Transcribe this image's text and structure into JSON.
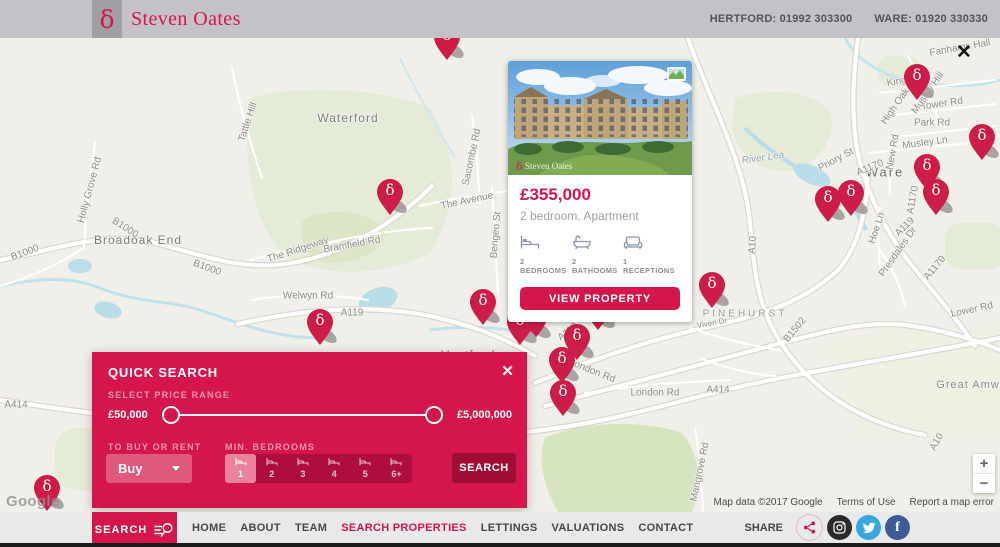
{
  "colors": {
    "accent": "#d5164c",
    "pin": "#cc1c47",
    "search_button": "#9f0d35",
    "panel": "#d4164c",
    "instagram": "#2a2a2a",
    "twitter": "#35a6de",
    "facebook": "#3b5a96"
  },
  "header": {
    "brand": {
      "symbol": "δ",
      "name": "Steven Oates"
    },
    "phones": [
      "HERTFORD: 01992 303300",
      "WARE: 01920 330330"
    ]
  },
  "map": {
    "close_label": "✕",
    "google_logo": "Google",
    "pin_glyph": "δ",
    "controls": {
      "zoom_in": "+",
      "zoom_out": "−"
    },
    "attribution": {
      "map_data": "Map data ©2017 Google",
      "terms": "Terms of Use",
      "report": "Report a map error"
    },
    "labels": [
      {
        "text": "Waterford",
        "x": 348,
        "y": 80,
        "size": 12,
        "color": "#7d7d7b",
        "ls": 1
      },
      {
        "text": "Broadoak End",
        "x": 138,
        "y": 202,
        "size": 12,
        "color": "#7d7d7b",
        "ls": 1
      },
      {
        "text": "Hertford",
        "x": 468,
        "y": 317,
        "size": 13,
        "color": "#757573",
        "ls": 1
      },
      {
        "text": "Ware",
        "x": 885,
        "y": 134,
        "size": 13,
        "color": "#6e6e6c",
        "ls": 2
      },
      {
        "text": "PINEHURST",
        "x": 745,
        "y": 276,
        "size": 10,
        "color": "#9a9a98",
        "ls": 3
      },
      {
        "text": "Great Amwell",
        "x": 975,
        "y": 347,
        "size": 11,
        "color": "#8a8a88",
        "ls": 1
      },
      {
        "text": "Tattle Hill",
        "x": 248,
        "y": 84,
        "rot": -72
      },
      {
        "text": "Holly Grove Rd",
        "x": 90,
        "y": 152,
        "rot": -75
      },
      {
        "text": "B1000",
        "x": 25,
        "y": 215,
        "rot": -20
      },
      {
        "text": "B1000",
        "x": 125,
        "y": 190,
        "rot": 33
      },
      {
        "text": "B1000",
        "x": 207,
        "y": 230,
        "rot": 20
      },
      {
        "text": "Sacombe Rd",
        "x": 472,
        "y": 119,
        "rot": -78
      },
      {
        "text": "The Avenue",
        "x": 467,
        "y": 163,
        "rot": -12
      },
      {
        "text": "The Ridgeway",
        "x": 298,
        "y": 212,
        "rot": -18
      },
      {
        "text": "Bramfield Rd",
        "x": 352,
        "y": 207,
        "rot": -10
      },
      {
        "text": "Welwyn Rd",
        "x": 308,
        "y": 258
      },
      {
        "text": "A119",
        "x": 352,
        "y": 275
      },
      {
        "text": "A119",
        "x": 568,
        "y": 294,
        "rot": -38
      },
      {
        "text": "Bengeo St",
        "x": 496,
        "y": 197,
        "rot": -85
      },
      {
        "text": "London Rd",
        "x": 592,
        "y": 333,
        "rot": 22
      },
      {
        "text": "London Rd",
        "x": 655,
        "y": 355
      },
      {
        "text": "B1502",
        "x": 673,
        "y": 268,
        "rot": -20
      },
      {
        "text": "B1502",
        "x": 795,
        "y": 292,
        "rot": -50
      },
      {
        "text": "A414",
        "x": 718,
        "y": 352
      },
      {
        "text": "A414",
        "x": 16,
        "y": 367
      },
      {
        "text": "A10",
        "x": 753,
        "y": 207,
        "rot": -85
      },
      {
        "text": "A10",
        "x": 937,
        "y": 404,
        "rot": -60
      },
      {
        "text": "A1170",
        "x": 870,
        "y": 130,
        "rot": -22
      },
      {
        "text": "A1170",
        "x": 913,
        "y": 162,
        "rot": -80
      },
      {
        "text": "A119",
        "x": 905,
        "y": 189,
        "rot": -45
      },
      {
        "text": "Hoe Ln",
        "x": 877,
        "y": 190,
        "rot": -72
      },
      {
        "text": "A1170",
        "x": 935,
        "y": 230,
        "rot": -50
      },
      {
        "text": "Presdales Dr",
        "x": 898,
        "y": 214,
        "rot": -55
      },
      {
        "text": "Priory St",
        "x": 836,
        "y": 122,
        "rot": -28
      },
      {
        "text": "Kingsway",
        "x": 908,
        "y": 42,
        "rot": -10
      },
      {
        "text": "High Oak Rd",
        "x": 900,
        "y": 62,
        "rot": -55
      },
      {
        "text": "Tower Rd",
        "x": 942,
        "y": 66,
        "rot": -8
      },
      {
        "text": "Park Rd",
        "x": 932,
        "y": 85
      },
      {
        "text": "Musley Hill",
        "x": 928,
        "y": 55,
        "rot": -55
      },
      {
        "text": "Musley Ln",
        "x": 925,
        "y": 105,
        "rot": -8
      },
      {
        "text": "New Rd",
        "x": 893,
        "y": 114,
        "rot": -80
      },
      {
        "text": "Fanhams Hall",
        "x": 960,
        "y": 10,
        "rot": -10
      },
      {
        "text": "Lower Rd",
        "x": 972,
        "y": 272,
        "rot": -12
      },
      {
        "text": "Mangrove Rd",
        "x": 700,
        "y": 434,
        "rot": -78
      },
      {
        "text": "Viven Dr",
        "x": 712,
        "y": 285,
        "rot": -10,
        "size": 8
      },
      {
        "text": "River Lea",
        "x": 763,
        "y": 120,
        "rot": -8,
        "italic": true,
        "color": "#90a7b6"
      },
      {
        "text": "River Lea",
        "x": 537,
        "y": 254,
        "rot": -18,
        "italic": true,
        "color": "#90a7b6",
        "size": 9
      }
    ],
    "pins": [
      {
        "x": 447,
        "y": 22
      },
      {
        "x": 390,
        "y": 177
      },
      {
        "x": 320,
        "y": 307
      },
      {
        "x": 483,
        "y": 287
      },
      {
        "x": 534,
        "y": 302
      },
      {
        "x": 520,
        "y": 307
      },
      {
        "x": 598,
        "y": 292
      },
      {
        "x": 577,
        "y": 322
      },
      {
        "x": 562,
        "y": 345
      },
      {
        "x": 563,
        "y": 378
      },
      {
        "x": 635,
        "y": 267
      },
      {
        "x": 657,
        "y": 267
      },
      {
        "x": 712,
        "y": 270
      },
      {
        "x": 828,
        "y": 184
      },
      {
        "x": 851,
        "y": 178
      },
      {
        "x": 917,
        "y": 62
      },
      {
        "x": 982,
        "y": 122
      },
      {
        "x": 927,
        "y": 152
      },
      {
        "x": 936,
        "y": 177
      },
      {
        "x": 47,
        "y": 473
      }
    ]
  },
  "property_card": {
    "price": "£355,000",
    "subtitle": "2 bedroom. Apartment",
    "watermark": {
      "symbol": "δ",
      "name": "Steven Oates"
    },
    "features": [
      {
        "icon": "bed-icon",
        "label": "2 BEDROOMS"
      },
      {
        "icon": "bath-icon",
        "label": "2 BATHOOMS"
      },
      {
        "icon": "sofa-icon",
        "label": "1 RECEPTIONS"
      }
    ],
    "cta": "VIEW PROPERTY"
  },
  "quick_search": {
    "title": "QUICK SEARCH",
    "close": "✕",
    "price_range": {
      "label": "SELECT PRICE RANGE",
      "min": "£50,000",
      "max": "£5,000,000"
    },
    "buy_rent": {
      "label": "TO BUY OR RENT",
      "value": "Buy"
    },
    "bedrooms": {
      "label": "MIN. BEDROOMS",
      "options": [
        "1",
        "2",
        "3",
        "4",
        "5",
        "6+"
      ],
      "selected": "1"
    },
    "search_label": "SEARCH"
  },
  "bottom_nav": {
    "search_tab": "SEARCH",
    "items": [
      {
        "label": "HOME",
        "active": false
      },
      {
        "label": "ABOUT",
        "active": false
      },
      {
        "label": "TEAM",
        "active": false
      },
      {
        "label": "SEARCH PROPERTIES",
        "active": true
      },
      {
        "label": "LETTINGS",
        "active": false
      },
      {
        "label": "VALUATIONS",
        "active": false
      },
      {
        "label": "CONTACT",
        "active": false
      }
    ],
    "share_label": "SHARE",
    "facebook_glyph": "f"
  }
}
